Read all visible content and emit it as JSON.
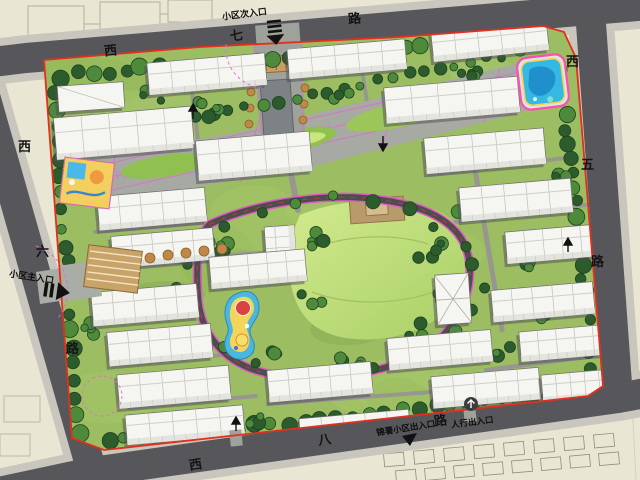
{
  "roads": {
    "north": {
      "name": "西七路",
      "chars": [
        "西",
        "七",
        "路"
      ]
    },
    "west": {
      "name": "西六路",
      "chars": [
        "西",
        "六",
        "路"
      ]
    },
    "east": {
      "name": "西五路",
      "chars": [
        "西",
        "五",
        "路"
      ]
    },
    "south": {
      "name": "西八路",
      "chars": [
        "西",
        "八",
        "路"
      ]
    }
  },
  "entrances": {
    "north_secondary_label": "小区次入口",
    "west_main_label": "小区主入口",
    "south_community_label": "锦著小区出入口",
    "south_pedestrian_label": "人行出入口"
  },
  "colors": {
    "boundary_red": "#e62e1e",
    "road_gray": "#57575b",
    "sidewalk_gray": "#c9c7bd",
    "site_green": "#9dbd62",
    "axis_magenta": "#e06ad0",
    "parcel_beige": "#e9e7d4"
  }
}
